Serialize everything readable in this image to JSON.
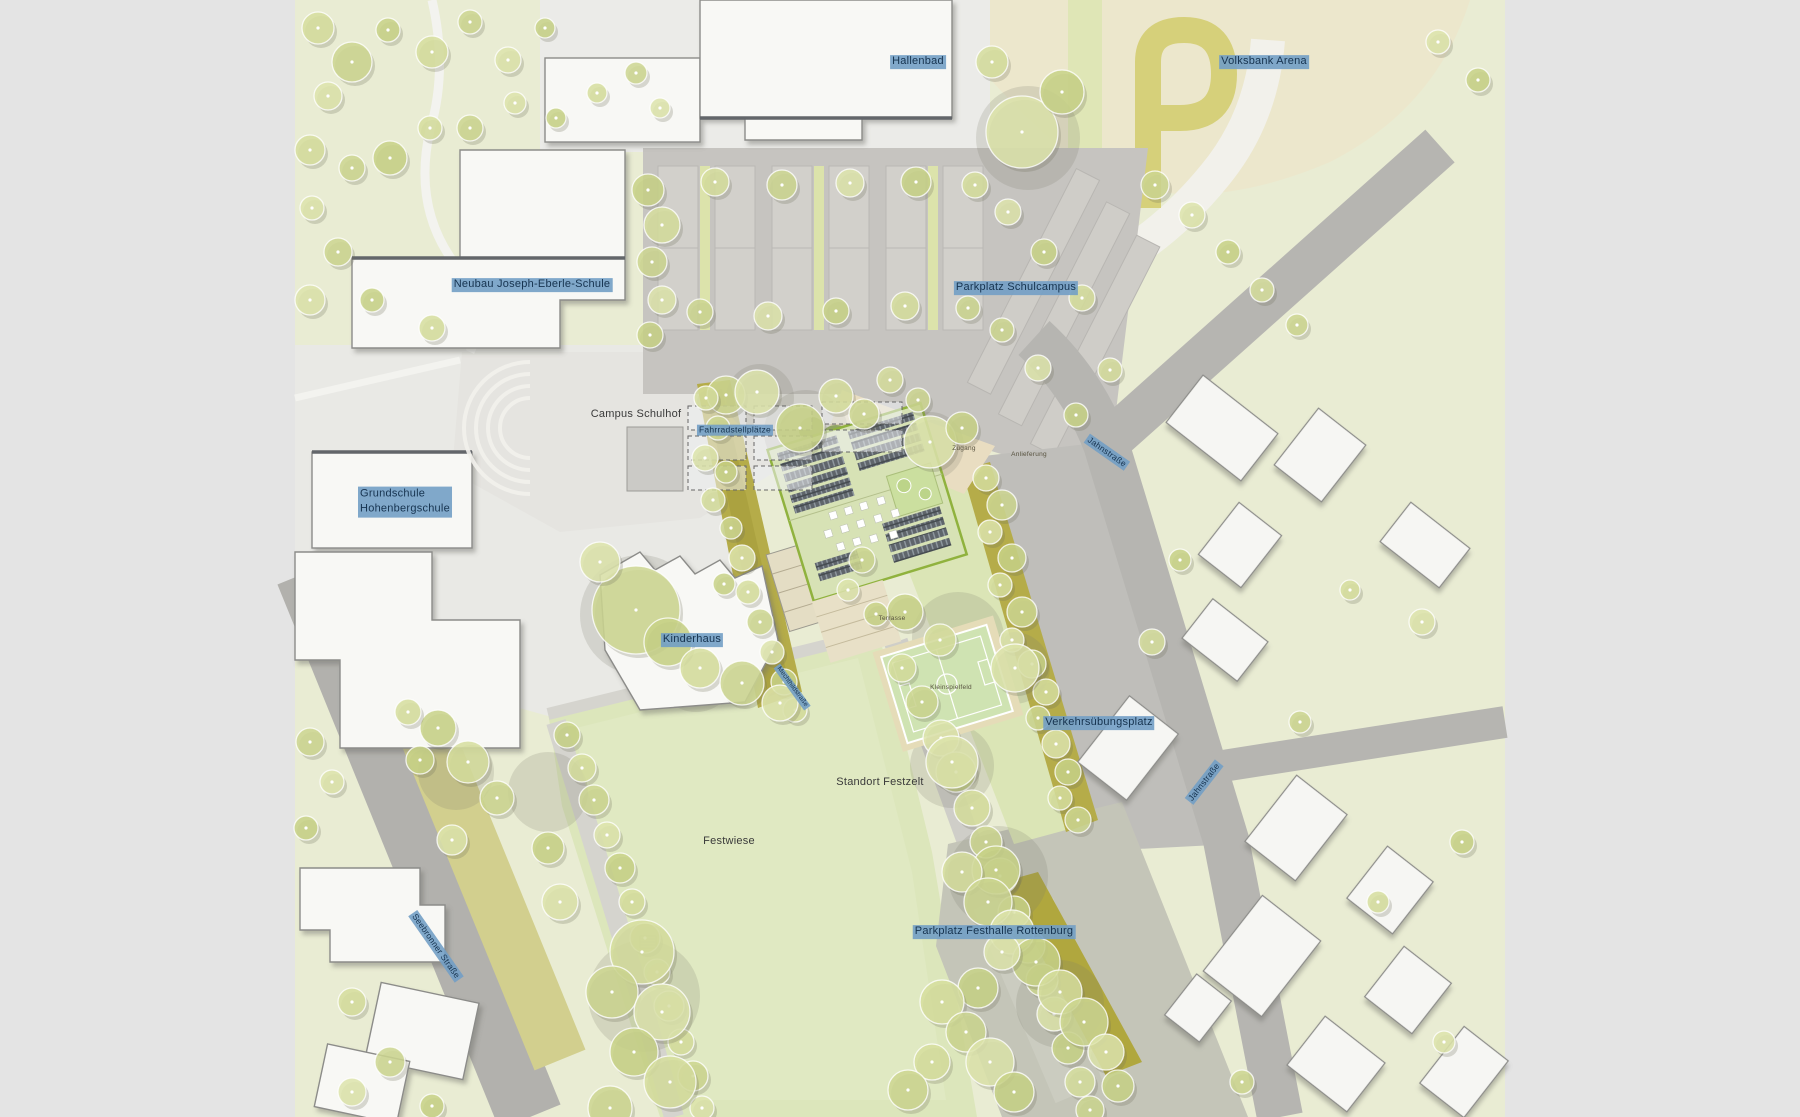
{
  "map": {
    "title": "Lageplan Schulcampus Rottenburg",
    "labels": {
      "hallenbad": "Hallenbad",
      "volksbank_arena": "Volksbank Arena",
      "neubau_joseph_eberle_schule": "Neubau Joseph-Eberle-Schule",
      "parkplatz_schulcampus": "Parkplatz Schulcampus",
      "campus_schulhof": "Campus Schulhof",
      "fahrradstellplaetze": "Fahrradstellplätze",
      "grundschule_hohenbergschule": "Grundschule\nHohenbergschule",
      "zugang": "Zugang",
      "anlieferung": "Anlieferung",
      "jahnstrasse_nord": "Jahnstraße",
      "jahnstrasse_sued": "Jahnstraße",
      "terrasse": "Terrasse",
      "kleinspielfeld": "Kleinspielfeld",
      "kinderhaus": "Kinderhaus",
      "wegname": "Mechthildstraße",
      "verkehrsuebungsplatz": "Verkehrsübungsplatz",
      "standort_festzelt": "Standort Festzelt",
      "festwiese": "Festwiese",
      "parkplatz_festhalle_rottenburg": "Parkplatz Festhalle Rottenburg",
      "seebronner_strasse": "Seebronner Straße"
    },
    "colors": {
      "label_highlight": "#72a0c5",
      "label_text_highlight": "#16334f",
      "label_text_plain": "#3a3a3a",
      "greenspace": "#e9ecd3",
      "meadow": "#dce6bb",
      "road": "#b6b5b1",
      "asphalt_platz": "#bfbeba",
      "building_white": "#f8f8f5",
      "roof_green": "#d7e2b5",
      "solar_panel": "#5f656b",
      "tree_canopy": "#d3db9a",
      "olive_path": "#b5ac49",
      "sand_terrace": "#e9ddc1",
      "arena_field": "#ece7cc"
    }
  }
}
